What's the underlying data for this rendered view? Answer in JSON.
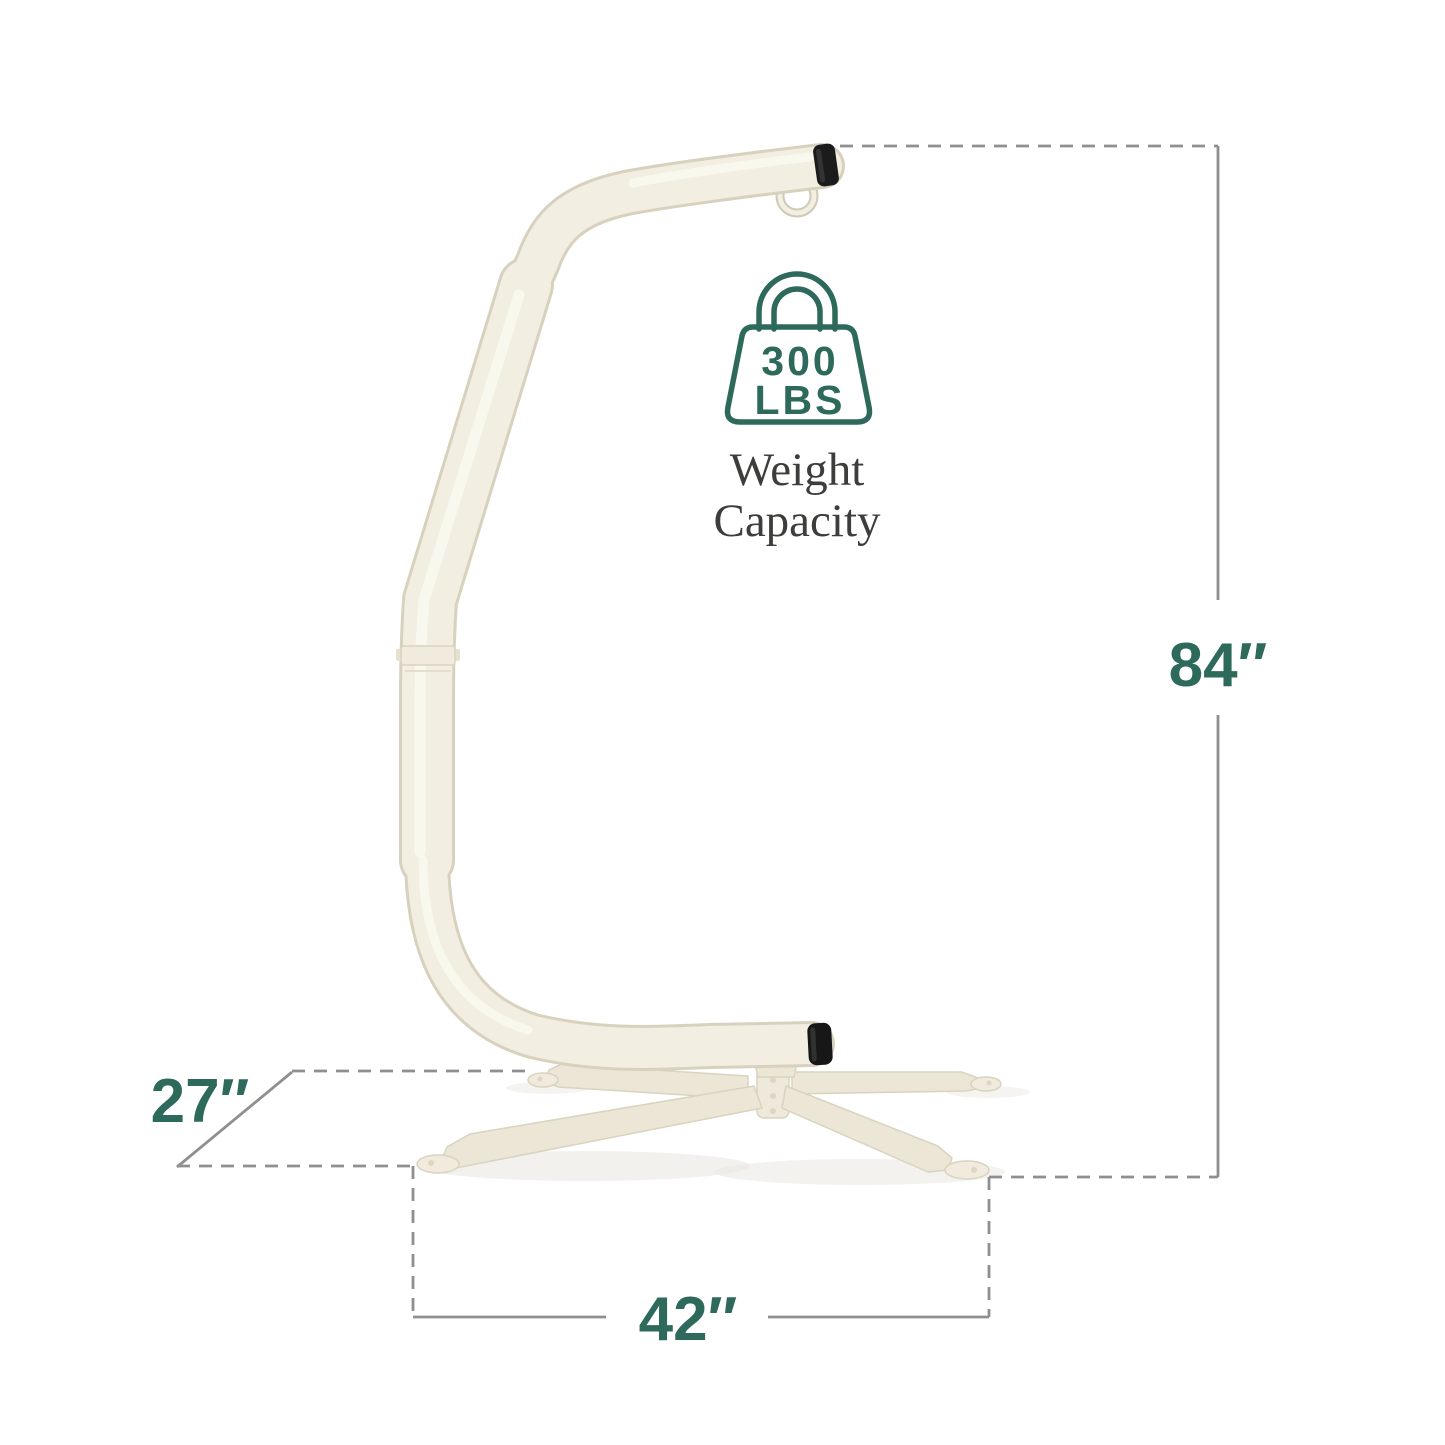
{
  "diagram": {
    "type": "product-dimension-diagram",
    "dimensions": {
      "height": "84″",
      "depth": "27″",
      "width": "42″"
    },
    "weight_capacity": {
      "value": "300",
      "unit": "LBS"
    },
    "caption": {
      "line1": "Weight",
      "line2": "Capacity"
    },
    "colors": {
      "accent_teal": "#2E6A5C",
      "caption_text": "#3D3D3B",
      "dimension_line_gray": "#8F8F8F",
      "frame_cream": "#F2EEE1",
      "frame_edge": "#D7D1BE",
      "end_cap_black": "#1B1B1B",
      "background": "#FFFFFF"
    }
  }
}
